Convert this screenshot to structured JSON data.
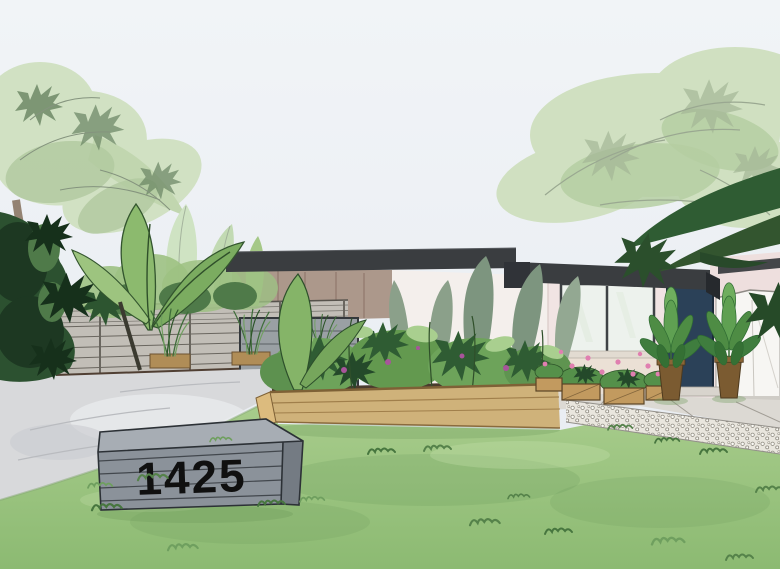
{
  "scene": {
    "type": "watercolor landscape design illustration",
    "subject": "mid-century modern house front yard with tropical landscaping"
  },
  "address_sign": {
    "number": "1425",
    "style": "gray horizontal-slat monument box on lawn"
  },
  "house": {
    "roof": "dark charcoal flat roofline with stepped fascia",
    "door": "navy blue front door",
    "window": "two-pane picture window",
    "walls": [
      "taupe wood carport wall",
      "blush white stucco wall"
    ],
    "front_porch": "concrete pavers with white gravel border"
  },
  "landscape": {
    "items": [
      "palm-tree-left",
      "palm-tree-right",
      "overhanging-dark-fronds",
      "banana-plants",
      "horizontal-slat-fence",
      "ornamental-grass-planters",
      "raised-planter-bed",
      "flower-crates",
      "potted-rubber-plants",
      "lawn",
      "concrete-driveway",
      "white-side-fence",
      "gravel-border"
    ]
  },
  "colors": {
    "sky": "#e7ebf1",
    "lawn": "#a9cd8d",
    "lawn_dark": "#8cba72",
    "driveway": "#d8d9db",
    "roof": "#3a3d40",
    "door": "#2b4158",
    "house_wall": "#f1e4e3",
    "carport_wood": "#ac988b",
    "fence": "#c2beb7",
    "planter_wood": "#cfb27a",
    "sign_front": "#8b929a",
    "sign_top": "#a7adb4",
    "sign_side": "#747b83",
    "sign_text": "#101010",
    "foliage_light": "#cfe0bf",
    "foliage_mid": "#6da35a",
    "foliage_dark": "#2f5c33",
    "flower_pink": "#e07fb0",
    "pot_brown": "#7b5b31",
    "porch": "#dcd9d3",
    "gravel": "#e9e6de"
  }
}
